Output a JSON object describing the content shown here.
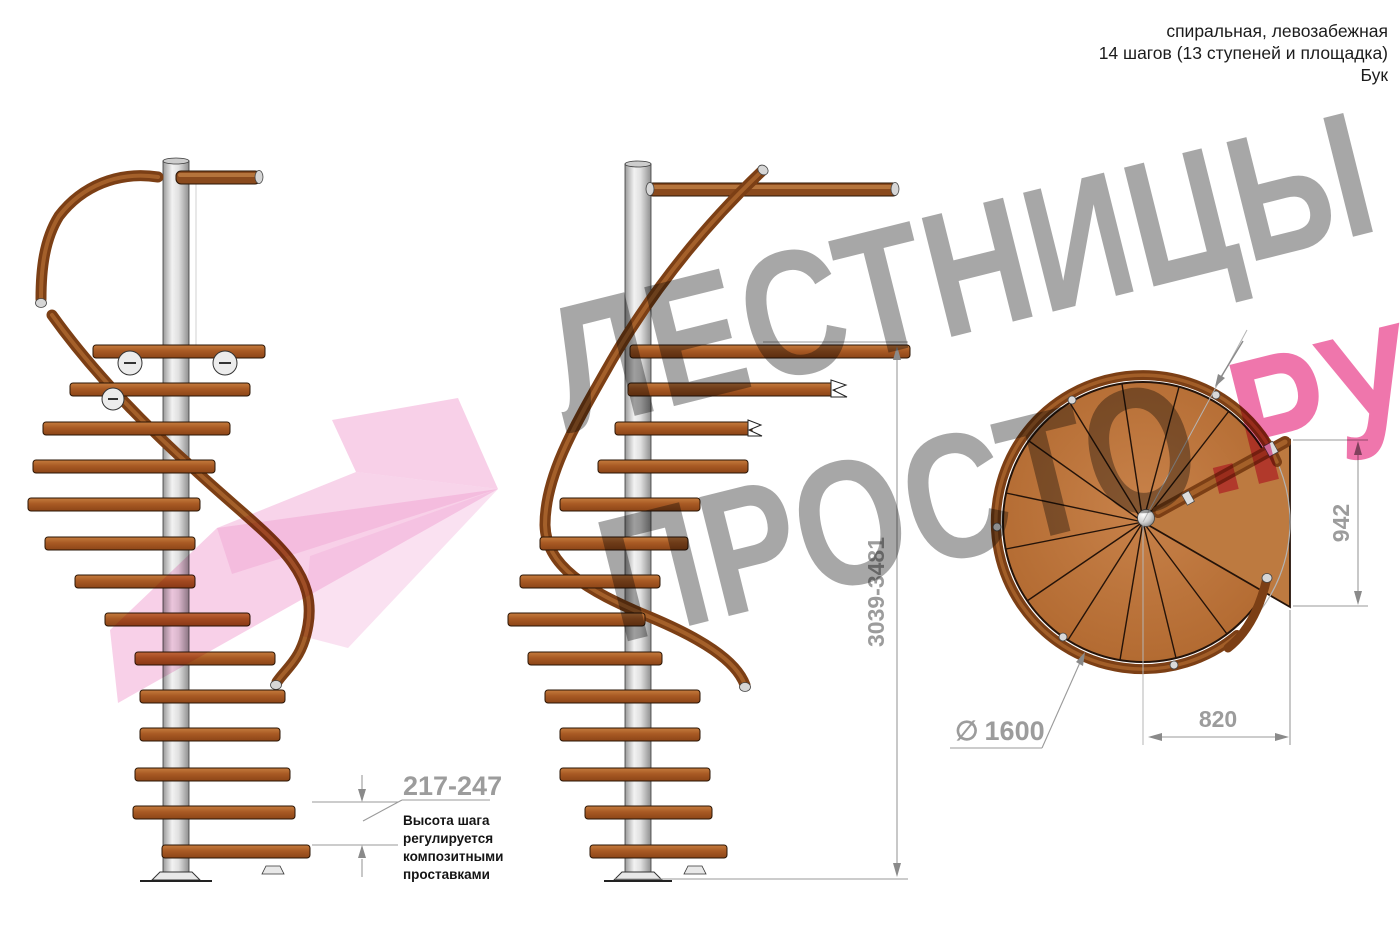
{
  "header": {
    "line1": "спиральная, левозабежная",
    "line2": "14 шагов (13 ступеней и площадка)",
    "line3": "Бук"
  },
  "watermark": {
    "line1": "ЛЕСТНИЦЫ",
    "line2": "ПРОСТО",
    "line2_suffix": ".РУ"
  },
  "dimensions": {
    "step_height_range": "217-247",
    "total_height_range": "3039-3481",
    "landing_depth": "942",
    "landing_width": "820",
    "diameter_symbol": "∅",
    "diameter_value": "1600"
  },
  "note": {
    "lines": [
      "Высота шага",
      "регулируется",
      "композитными",
      "проставками"
    ]
  },
  "colors": {
    "wood": "#b4713a",
    "handrail": "#7c3f15",
    "metal": "#d8d8d8",
    "dimension_gray": "#9c9c9c",
    "watermark_gray": "#949494",
    "watermark_pink": "#ec5e9e",
    "logo_pink": "#f2a9d6",
    "text": "#1c1c1c"
  }
}
